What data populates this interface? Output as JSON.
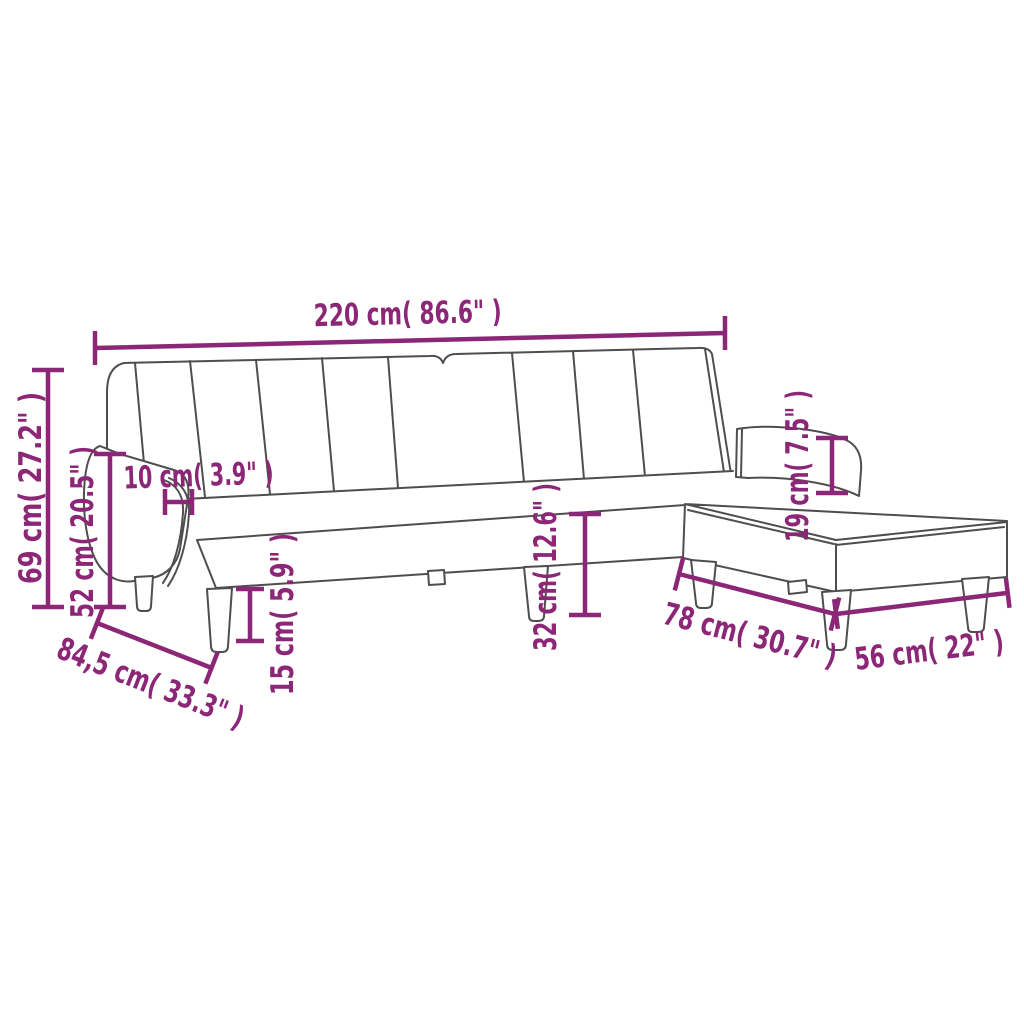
{
  "figure": {
    "description": "Line-drawing dimension diagram of an L-shaped sofa bed with channel-tufted backrest, two armrests and a rectangular footstool with tapered legs"
  },
  "colors": {
    "dimension_color": "#8C2676",
    "drawing_line_color": "#4E4E4E",
    "background": "#FFFFFF"
  },
  "dimensions": [
    {
      "id": "overall-width",
      "label": "220 cm( 86.6\" )"
    },
    {
      "id": "overall-height",
      "label": "69 cm( 27.2\" )"
    },
    {
      "id": "backrest-height",
      "label": "52 cm( 20.5\" )"
    },
    {
      "id": "armrest-width",
      "label": "10 cm( 3.9\" )"
    },
    {
      "id": "leg-height",
      "label": "15 cm( 5.9\" )"
    },
    {
      "id": "depth",
      "label": "84,5 cm( 33.3\" )"
    },
    {
      "id": "seat-height",
      "label": "32 cm( 12.6\" )"
    },
    {
      "id": "armrest-height",
      "label": "19 cm( 7.5\" )"
    },
    {
      "id": "footstool-length",
      "label": "78 cm( 30.7\" )"
    },
    {
      "id": "footstool-width",
      "label": "56 cm( 22\" )"
    }
  ]
}
